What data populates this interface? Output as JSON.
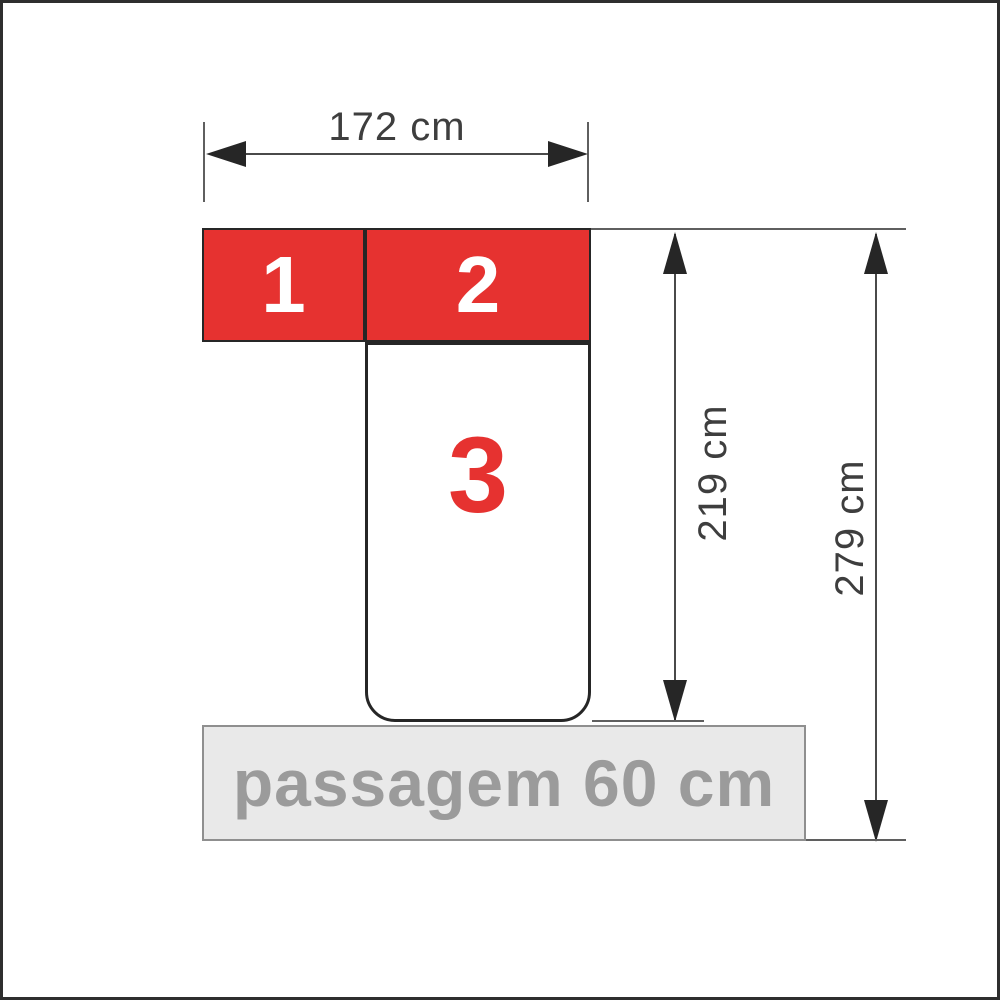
{
  "diagram": {
    "type": "furniture-dimension-diagram",
    "modules": [
      {
        "label": "1"
      },
      {
        "label": "2"
      },
      {
        "label": "3"
      }
    ],
    "dimensions": {
      "width": {
        "label": "172 cm"
      },
      "inner_height": {
        "label": "219 cm"
      },
      "total_height": {
        "label": "279 cm"
      }
    },
    "passage": {
      "label": "passagem 60 cm"
    }
  },
  "colors": {
    "background": "#ffffff",
    "outer_border": "#2e2e2e",
    "module_red": "#e63230",
    "module_border": "#262626",
    "module_number": "#ffffff",
    "module3_fill": "#ffffff",
    "module3_number": "#e63230",
    "line": "#4a4a4a",
    "ext_line": "#5f5f5f",
    "arrow": "#262626",
    "dimension_text": "#3e3e3e",
    "passage_fill": "#e9e9e9",
    "passage_border": "#8f8f8f",
    "passage_text": "#9b9b9b"
  }
}
